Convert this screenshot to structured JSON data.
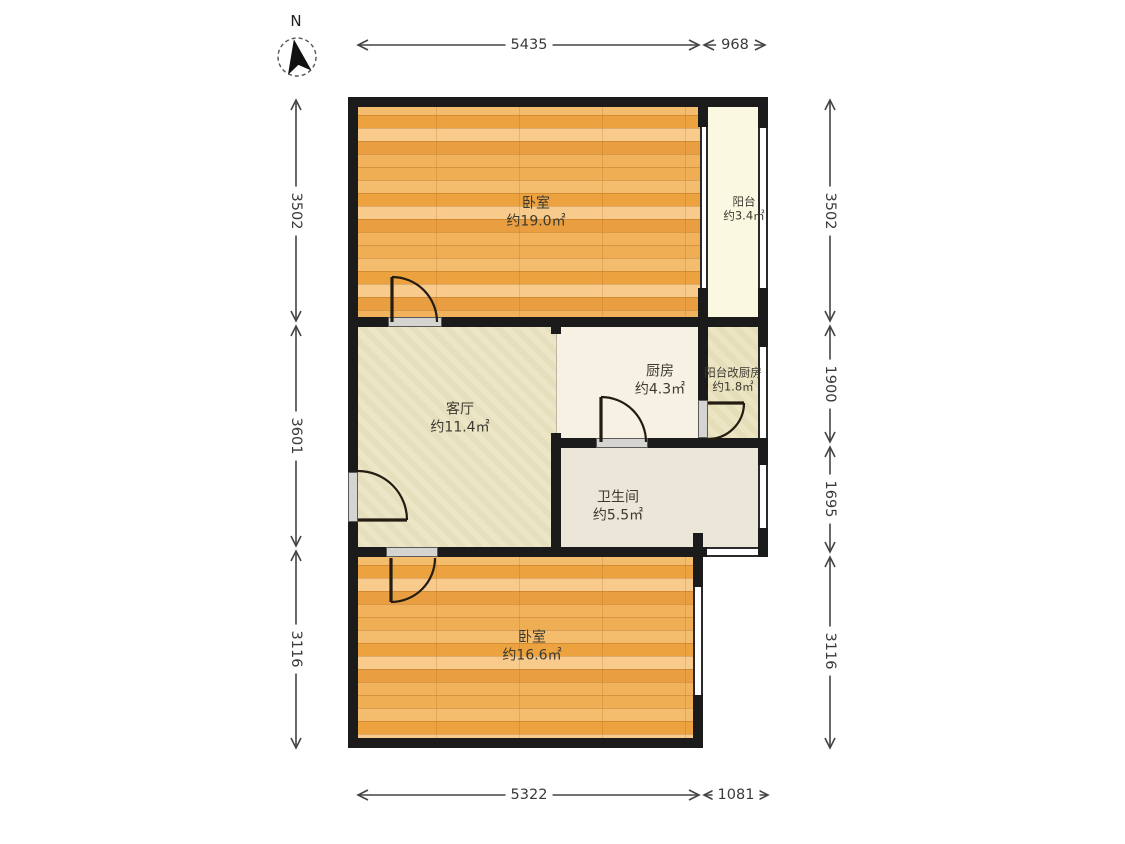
{
  "compass": {
    "label": "N"
  },
  "rooms": {
    "bedroom_top": {
      "name": "卧室",
      "area": "约19.0㎡"
    },
    "balcony": {
      "name": "阳台",
      "area": "约3.4㎡"
    },
    "living": {
      "name": "客厅",
      "area": "约11.4㎡"
    },
    "kitchen": {
      "name": "厨房",
      "area": "约4.3㎡"
    },
    "balcony_kitchen": {
      "name": "阳台改厨房",
      "area": "约1.8㎡"
    },
    "bathroom": {
      "name": "卫生间",
      "area": "约5.5㎡"
    },
    "bedroom_bottom": {
      "name": "卧室",
      "area": "约16.6㎡"
    }
  },
  "dimensions": {
    "top": [
      "5435",
      "968"
    ],
    "bottom": [
      "5322",
      "1081"
    ],
    "left": [
      "3502",
      "3601",
      "3116"
    ],
    "right": [
      "3502",
      "1900",
      "1695",
      "3116"
    ]
  },
  "colors": {
    "wall": "#1b1b1b",
    "wood_floor": "#eea94e",
    "living_floor": "#eae3c1",
    "kitchen_floor": "#f6f1e3",
    "bathroom_floor": "#ece6d9",
    "balcony_floor": "#fbf8e2",
    "balcony_kitchen_floor": "#eae2bd",
    "dimension_text": "#3a3a3a"
  }
}
